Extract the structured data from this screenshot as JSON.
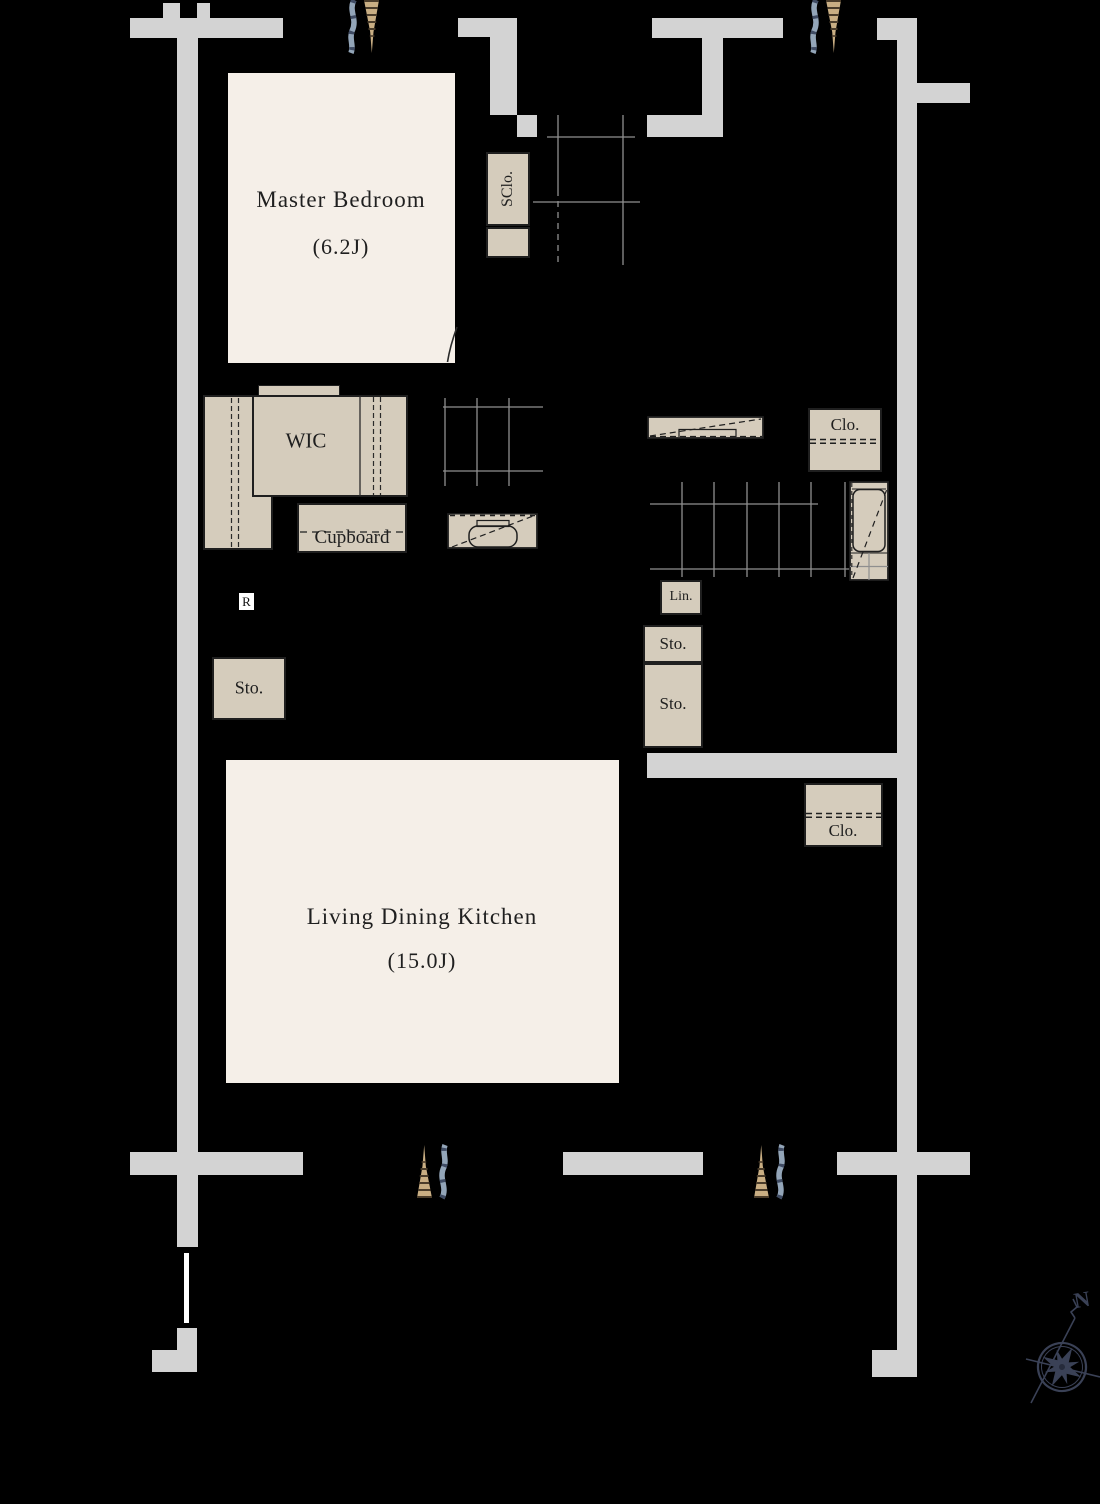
{
  "palette": {
    "background": "#000000",
    "wall": "#d3d3d3",
    "room_floor": "#f5efe8",
    "cabinet_fill": "#d5ccbc",
    "grid_line": "#8f8f8f",
    "ink": "#1f1f1f",
    "window_tan": "#c9ae83",
    "window_blue": "#93a5b8",
    "compass": "#3a4156",
    "gate_white": "#ffffff"
  },
  "rooms": {
    "master_bedroom": {
      "name": "Master Bedroom",
      "size": "(6.2J)"
    },
    "ldk": {
      "name": "Living Dining Kitchen",
      "size": "(15.0J)"
    }
  },
  "storage": {
    "wic": "WIC",
    "cupboard": "Cupboard",
    "sclo": "SClo.",
    "clo_upper": "Clo.",
    "clo_lower": "Clo.",
    "lin": "Lin.",
    "sto_hall_upper": "Sto.",
    "sto_hall_lower": "Sto.",
    "sto_left": "Sto."
  },
  "marks": {
    "refrigerator": "R",
    "north": "N"
  }
}
